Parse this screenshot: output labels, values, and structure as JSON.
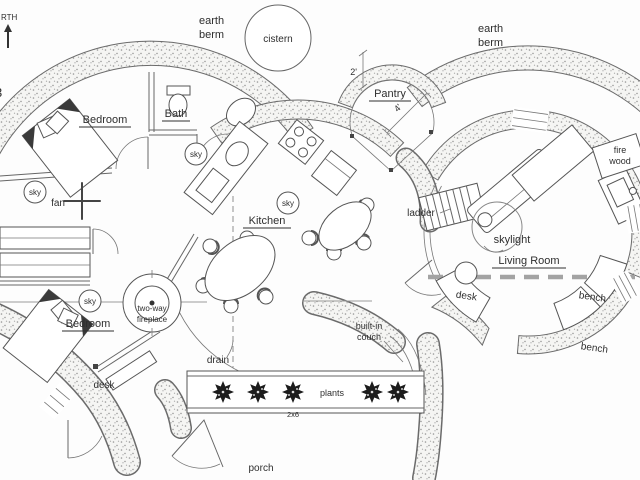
{
  "labels": {
    "north_partial": "RTH",
    "edge_partial": "3",
    "earth_berm": {
      "line1": "earth",
      "line2": "berm"
    },
    "cistern": "cistern",
    "pantry": "Pantry",
    "bedroom": "Bedroom",
    "bath": "Bath",
    "sky": "sky",
    "fan": "fan",
    "kitchen": "Kitchen",
    "ladder": "ladder",
    "skylight": "skylight",
    "living_room": "Living Room",
    "fire_wood": {
      "line1": "fire",
      "line2": "wood"
    },
    "desk": "desk",
    "bench": "bench",
    "fireplace": {
      "line1": "two-way",
      "line2": "fireplace"
    },
    "drain": "drain",
    "built_in_couch": {
      "line1": "built-in",
      "line2": "couch"
    },
    "plants": "plants",
    "porch": "porch"
  },
  "dimensions": {
    "pantry_dim_small": "2'",
    "pantry_dim_large": "4'",
    "planter_lumber": "2x6"
  },
  "colors": {
    "background": "#fdfdfd",
    "wall_outline": "#6b6b6b",
    "stipple_dot": "#979797",
    "text": "#2e2e2e",
    "dashed_guide": "#a3a3a3"
  }
}
